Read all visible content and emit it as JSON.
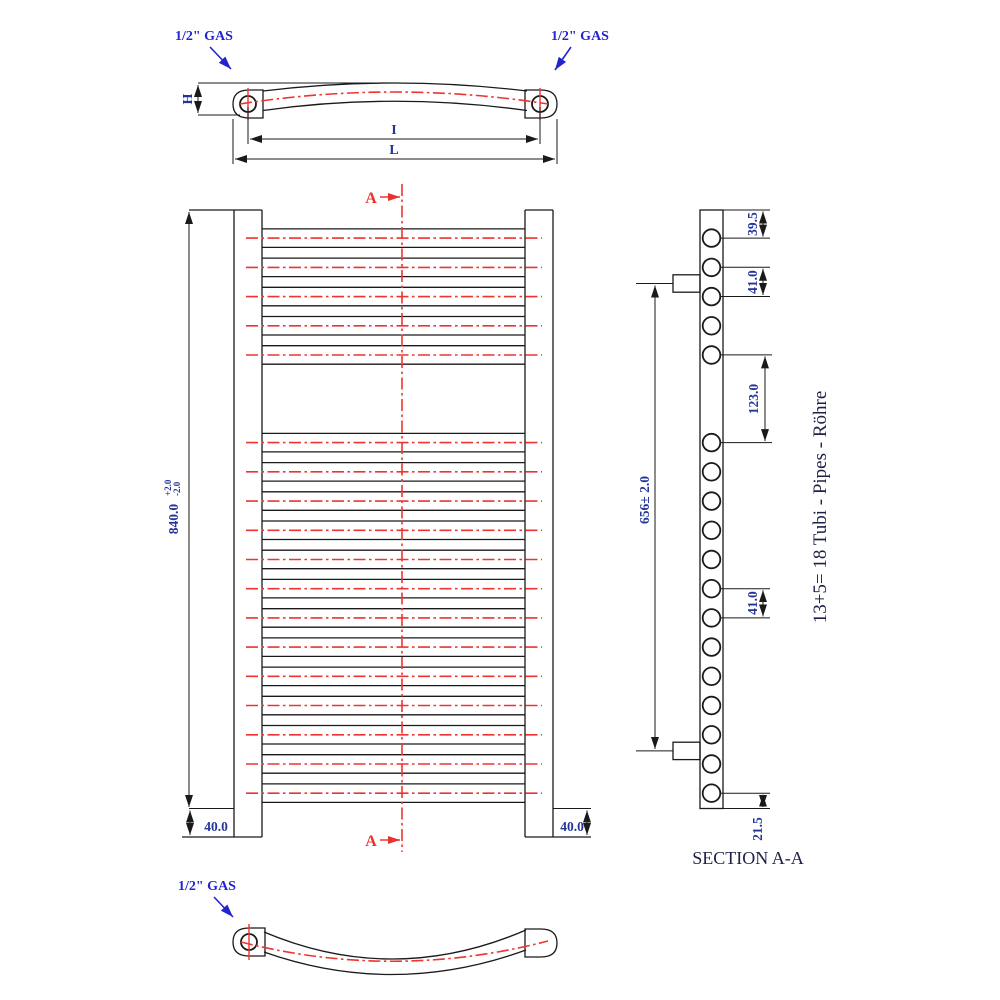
{
  "section_title": "SECTION A-A",
  "tube_note": "13+5= 18 Tubi - Pipes - Röhre",
  "labels": {
    "gas": "1/2\" GAS",
    "height_letter": "H",
    "inner_length_letter": "I",
    "overall_length_letter": "L",
    "section_marker": "A"
  },
  "dims": {
    "overall_height": "840.0",
    "tol_plus": "+2.0",
    "tol_minus": "-2.0",
    "rail_bottom_ext_left": "40.0",
    "rail_bottom_ext_right": "40.0",
    "first_tube_offset": "39.5",
    "pitch_upper": "41.0",
    "group_gap": "123.0",
    "pitch_lower": "41.0",
    "last_tube_offset": "21.5",
    "bracket_span": "656± 2.0"
  },
  "radiator": {
    "tubes_upper_group": 5,
    "tubes_lower_group": 13,
    "tubes_total": 18,
    "first_tube_offset_mm": 39.5,
    "tube_pitch_mm": 41.0,
    "group_gap_mm": 123.0,
    "overall_height_mm": 840.0,
    "bottom_extension_mm": 40.0,
    "last_tube_offset_mm": 21.5,
    "bracket_span_mm": 656.0
  }
}
